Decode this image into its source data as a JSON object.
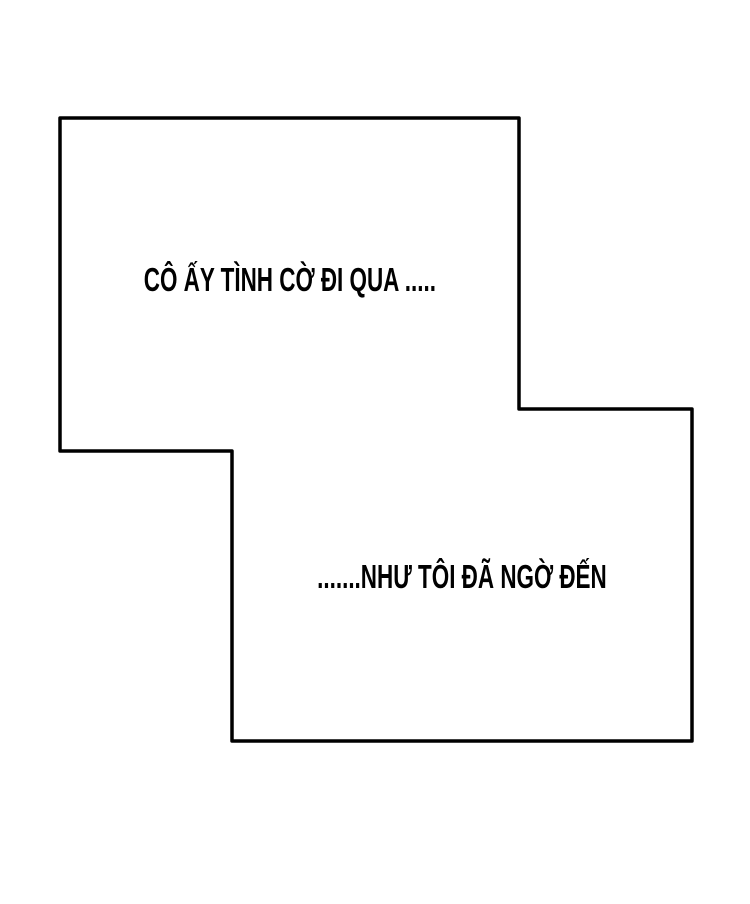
{
  "page": {
    "background_color": "#ffffff",
    "ink_color": "#000000"
  },
  "panels": {
    "top": {
      "text": "CÔ ẤY TÌNH CỜ ĐI QUA ....."
    },
    "bottom": {
      "text": ".......NHƯ TÔI ĐÃ NGỜ ĐẾN"
    }
  }
}
